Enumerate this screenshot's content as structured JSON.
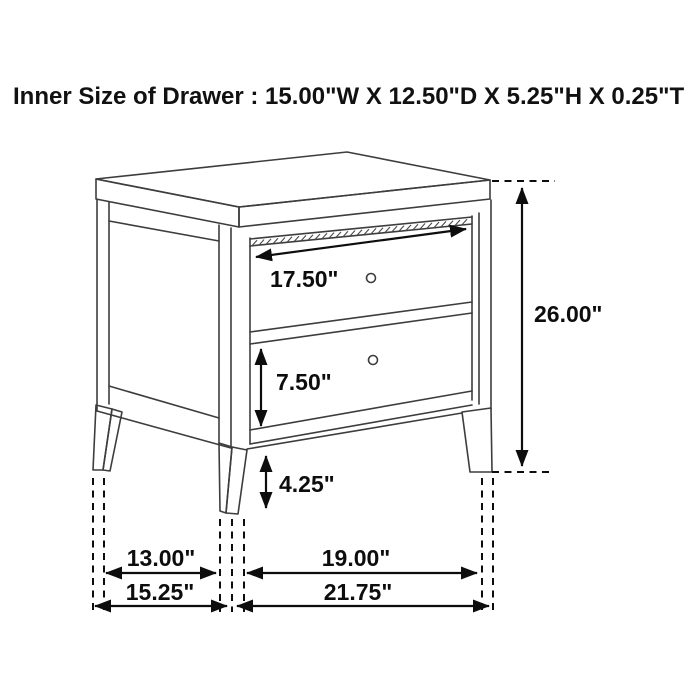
{
  "title": "Inner Size of Drawer : 15.00\"W X 12.50\"D X 5.25\"H X 0.25\"T",
  "diagram": {
    "subject": "two-drawer nightstand line drawing with dimension callouts",
    "line_color": "#3d3d3d",
    "dimension_color": "#0d0d0d",
    "background_color": "#ffffff",
    "dims": {
      "top_drawer_width": "17.50\"",
      "overall_height": "26.00\"",
      "bottom_drawer_front_height": "7.50\"",
      "leg_height": "4.25\"",
      "depth_between_legs": "13.00\"",
      "overall_depth": "15.25\"",
      "width_between_legs": "19.00\"",
      "overall_width": "21.75\""
    }
  }
}
